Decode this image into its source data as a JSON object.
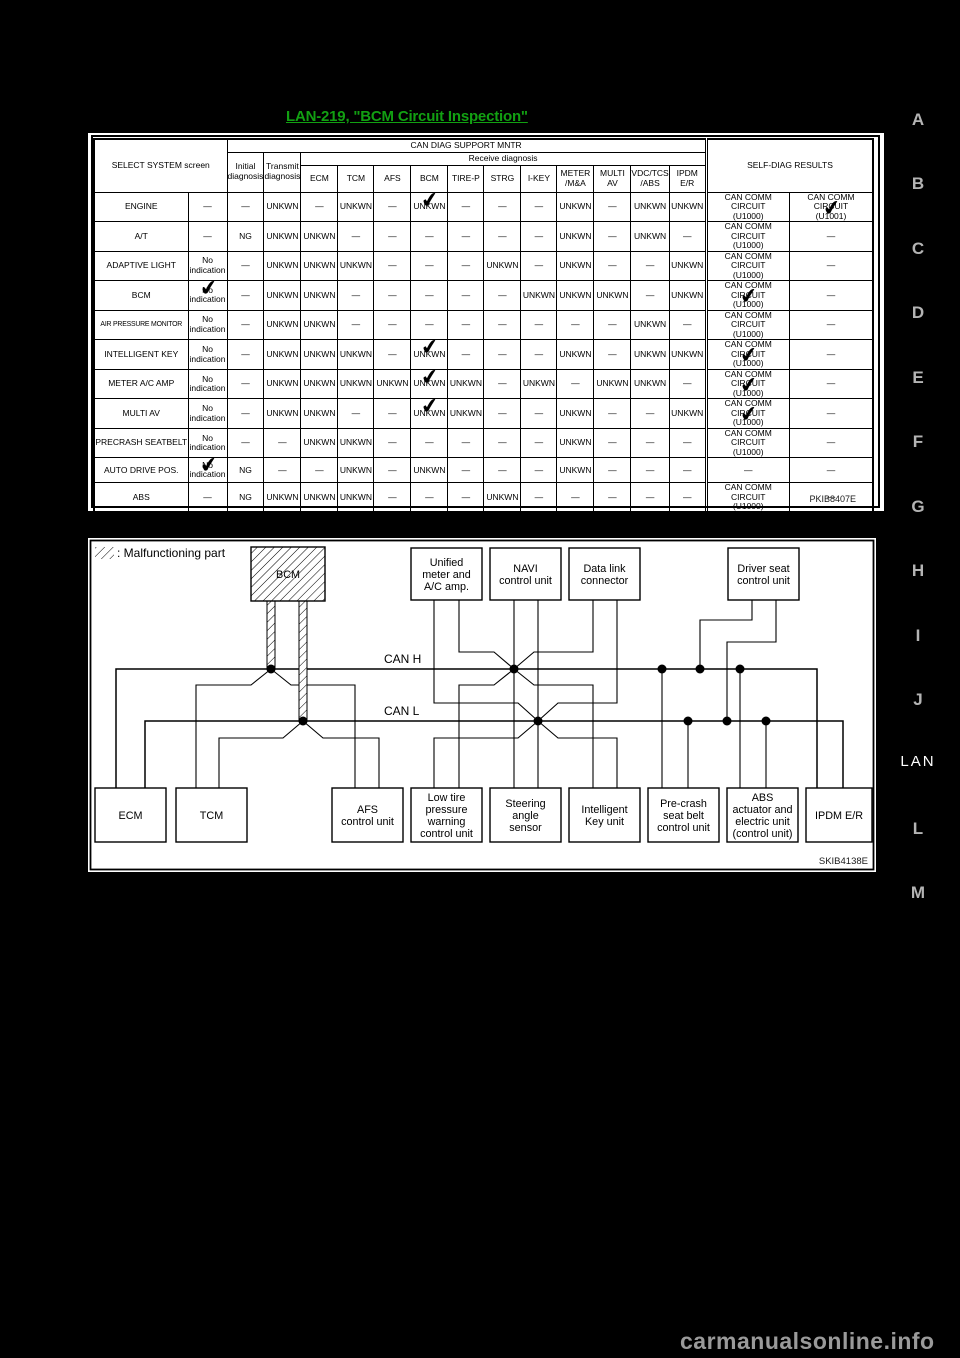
{
  "page": {
    "title": "LAN-219, \"BCM Circuit Inspection\"",
    "watermark": "carmanualsonline.info",
    "margin_letters": [
      "A",
      "B",
      "C",
      "D",
      "E",
      "F",
      "G",
      "H",
      "I",
      "J",
      "LAN",
      "L",
      "M"
    ],
    "title_color": "#12a012"
  },
  "table": {
    "figure_code": "PKIB8407E",
    "select_system_header": "SELECT SYSTEM screen",
    "mntr_header": "CAN DIAG SUPPORT MNTR",
    "receive_header": "Receive diagnosis",
    "initial_header": "Initial\ndiagnosis",
    "transmit_header": "Transmit\ndiagnosis",
    "self_diag_header": "SELF-DIAG RESULTS",
    "receive_columns": [
      "ECM",
      "TCM",
      "AFS",
      "BCM",
      "TIRE-P",
      "STRG",
      "I-KEY",
      "METER\n/M&A",
      "MULTI\nAV",
      "VDC/TCS\n/ABS",
      "IPDM\nE/R"
    ],
    "rows": [
      {
        "name": "ENGINE",
        "screen": "—",
        "initial": "—",
        "transmit": "UNKWN",
        "receive": [
          "—",
          "UNKWN",
          "—",
          "UNKWN",
          "—",
          "—",
          "—",
          "UNKWN",
          "—",
          "UNKWN",
          "UNKWN"
        ],
        "sd1": "CAN COMM CIRCUIT\n(U1000)",
        "sd2": "CAN COMM CIRCUIT\n(U1001)",
        "checks": [
          "bcm",
          "sd2"
        ]
      },
      {
        "name": "A/T",
        "screen": "—",
        "initial": "NG",
        "transmit": "UNKWN",
        "receive": [
          "UNKWN",
          "—",
          "—",
          "—",
          "—",
          "—",
          "—",
          "UNKWN",
          "—",
          "UNKWN",
          "—"
        ],
        "sd1": "CAN COMM CIRCUIT\n(U1000)",
        "sd2": "—",
        "checks": []
      },
      {
        "name": "ADAPTIVE LIGHT",
        "screen": "No indication",
        "initial": "—",
        "transmit": "UNKWN",
        "receive": [
          "UNKWN",
          "UNKWN",
          "—",
          "—",
          "—",
          "UNKWN",
          "—",
          "UNKWN",
          "—",
          "—",
          "UNKWN"
        ],
        "sd1": "CAN COMM CIRCUIT\n(U1000)",
        "sd2": "—",
        "checks": []
      },
      {
        "name": "BCM",
        "screen": "No indication",
        "initial": "—",
        "transmit": "UNKWN",
        "receive": [
          "UNKWN",
          "—",
          "—",
          "—",
          "—",
          "—",
          "UNKWN",
          "UNKWN",
          "UNKWN",
          "—",
          "UNKWN"
        ],
        "sd1": "CAN COMM CIRCUIT\n(U1000)",
        "sd2": "—",
        "checks": [
          "screen",
          "sd1"
        ]
      },
      {
        "name": "AIR PRESSURE MONITOR",
        "screen": "No indication",
        "initial": "—",
        "transmit": "UNKWN",
        "receive": [
          "UNKWN",
          "—",
          "—",
          "—",
          "—",
          "—",
          "—",
          "—",
          "—",
          "UNKWN",
          "—"
        ],
        "sd1": "CAN COMM CIRCUIT\n(U1000)",
        "sd2": "—",
        "checks": []
      },
      {
        "name": "INTELLIGENT KEY",
        "screen": "No indication",
        "initial": "—",
        "transmit": "UNKWN",
        "receive": [
          "UNKWN",
          "UNKWN",
          "—",
          "UNKWN",
          "—",
          "—",
          "—",
          "UNKWN",
          "—",
          "UNKWN",
          "UNKWN"
        ],
        "sd1": "CAN COMM CIRCUIT\n(U1000)",
        "sd2": "—",
        "checks": [
          "bcm",
          "sd1"
        ]
      },
      {
        "name": "METER A/C AMP",
        "screen": "No indication",
        "initial": "—",
        "transmit": "UNKWN",
        "receive": [
          "UNKWN",
          "UNKWN",
          "UNKWN",
          "UNKWN",
          "UNKWN",
          "—",
          "UNKWN",
          "—",
          "UNKWN",
          "UNKWN",
          "—"
        ],
        "sd1": "CAN COMM CIRCUIT\n(U1000)",
        "sd2": "—",
        "checks": [
          "bcm",
          "sd1"
        ]
      },
      {
        "name": "MULTI AV",
        "screen": "No indication",
        "initial": "—",
        "transmit": "UNKWN",
        "receive": [
          "UNKWN",
          "—",
          "—",
          "UNKWN",
          "UNKWN",
          "—",
          "—",
          "UNKWN",
          "—",
          "—",
          "UNKWN"
        ],
        "sd1": "CAN COMM CIRCUIT\n(U1000)",
        "sd2": "—",
        "checks": [
          "bcm",
          "sd1"
        ]
      },
      {
        "name": "PRECRASH SEATBELT",
        "screen": "No indication",
        "initial": "—",
        "transmit": "—",
        "receive": [
          "UNKWN",
          "UNKWN",
          "—",
          "—",
          "—",
          "—",
          "—",
          "UNKWN",
          "—",
          "—",
          "—"
        ],
        "sd1": "CAN COMM CIRCUIT\n(U1000)",
        "sd2": "—",
        "checks": []
      },
      {
        "name": "AUTO DRIVE POS.",
        "screen": "No indication",
        "initial": "NG",
        "transmit": "—",
        "receive": [
          "—",
          "UNKWN",
          "—",
          "UNKWN",
          "—",
          "—",
          "—",
          "UNKWN",
          "—",
          "—",
          "—"
        ],
        "sd1": "—",
        "sd2": "—",
        "checks": [
          "screen"
        ]
      },
      {
        "name": "ABS",
        "screen": "—",
        "initial": "NG",
        "transmit": "UNKWN",
        "receive": [
          "UNKWN",
          "UNKWN",
          "—",
          "—",
          "—",
          "UNKWN",
          "—",
          "—",
          "—",
          "—",
          "—"
        ],
        "sd1": "CAN COMM CIRCUIT\n(U1000)",
        "sd2": "—",
        "checks": []
      },
      {
        "name": "IPDM E/R",
        "screen": "No indication",
        "initial": "—",
        "transmit": "UNKWN",
        "receive": [
          "UNKWN",
          "—",
          "—",
          "UNKWN",
          "—",
          "—",
          "—",
          "—",
          "—",
          "—",
          "—"
        ],
        "sd1": "CAN COMM CIRCUIT\n(U1000)",
        "sd2": "—",
        "checks": [
          "bcm",
          "sd1"
        ]
      }
    ]
  },
  "diagram": {
    "figure_code": "SKIB4138E",
    "legend_label": ": Malfunctioning part",
    "bus_h_label": "CAN H",
    "bus_l_label": "CAN L",
    "boxes": {
      "bcm": "BCM",
      "unified": "Unified\nmeter and\nA/C amp.",
      "navi": "NAVI\ncontrol unit",
      "datalink": "Data link\nconnector",
      "driver_seat": "Driver seat\ncontrol unit",
      "ecm": "ECM",
      "tcm": "TCM",
      "afs": "AFS\ncontrol unit",
      "low_tire": "Low tire\npressure\nwarning\ncontrol unit",
      "steering": "Steering\nangle\nsensor",
      "intelligent_key": "Intelligent\nKey unit",
      "precrash": "Pre-crash\nseat belt\ncontrol unit",
      "abs": "ABS\nactuator and\nelectric unit\n(control unit)",
      "ipdm": "IPDM E/R"
    }
  }
}
